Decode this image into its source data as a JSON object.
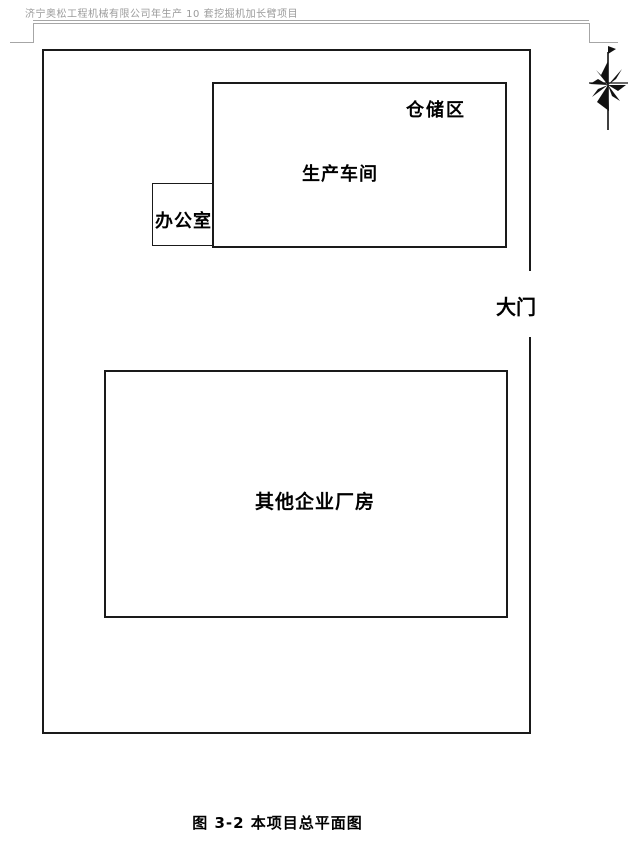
{
  "header": {
    "title": "济宁奥松工程机械有限公司年生产 10 套挖掘机加长臂项目"
  },
  "diagram": {
    "labels": {
      "storage": "仓储区",
      "workshop": "生产车间",
      "office": "办公室",
      "gate": "大门",
      "other_factory": "其他企业厂房"
    },
    "north_arrow_icon": "north-compass-icon"
  },
  "caption": "图 3-2  本项目总平面图",
  "colors": {
    "line": "#1a1a1a",
    "header_text": "#9b9b9b",
    "frame_rule": "#a6a6a6",
    "background": "#ffffff"
  }
}
